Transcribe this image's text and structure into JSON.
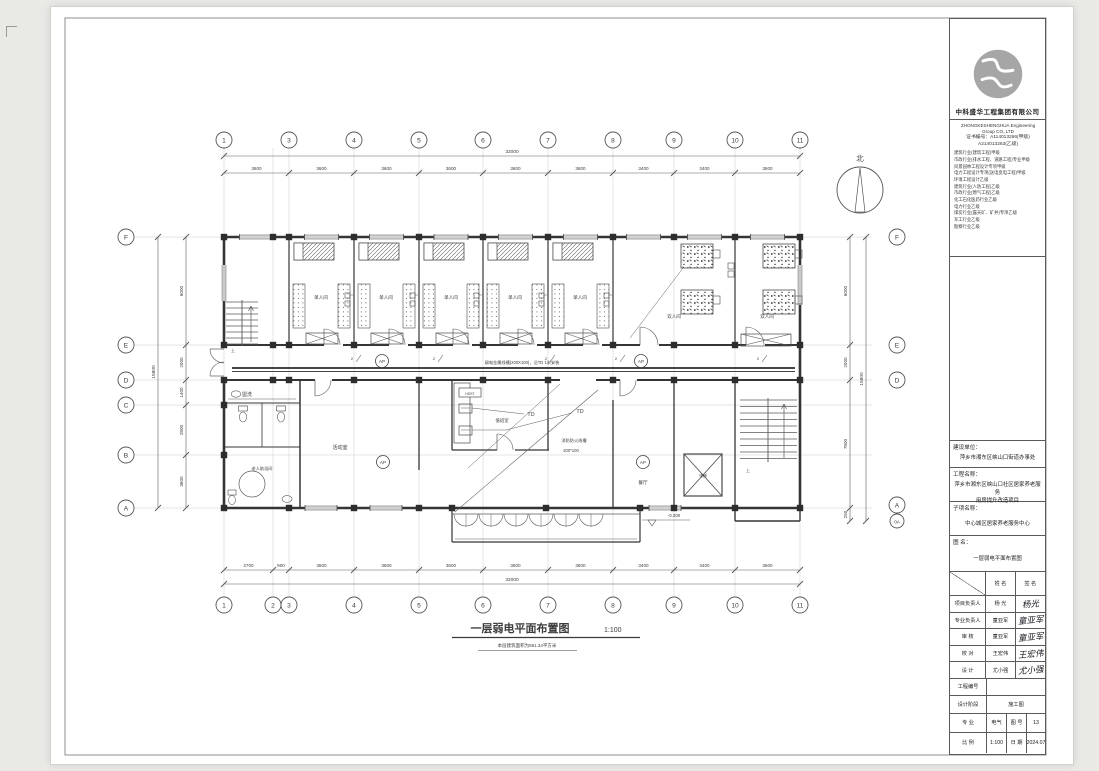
{
  "company": {
    "name_cn": "中科盛华工程集团有限公司",
    "name_en": "ZHONGKESHENGHUA Engineering Group CO.,LTD",
    "cert_line1": "证书编号：A114013266(甲级)",
    "cert_line2": "A214013263(乙级)",
    "qualifications": [
      "建筑行业(建筑工程)甲级",
      "市政行业(排水工程、道路工程)专业甲级",
      "风景园林工程设计专项甲级",
      "电力工程设计专项(送电变电工程)甲级",
      "环境工程设计乙级",
      "建筑行业(人防工程)乙级",
      "市政行业(燃气工程)乙级",
      "化工石化医药行业乙级",
      "电力行业乙级",
      "煤炭行业(露天矿、矿井)专项乙级",
      "军工行业乙级",
      "勘察行业乙级"
    ]
  },
  "title_block": {
    "labels": {
      "client": "建设单位：",
      "project": "工程名称：",
      "subitem": "子项名称：",
      "drawing": "图    名："
    },
    "client": "萍乡市湘东区峡山口街道办事处",
    "project_line1": "萍乡市湘东区峡山口社区居家养老服务",
    "project_line2": "用房提升改造项目",
    "subitem": "中心城区居家养老服务中心",
    "drawing_name": "一层弱电平面布置图",
    "table": {
      "col_name": "姓 名",
      "col_sign": "签 名",
      "rows": [
        {
          "role": "项目负责人",
          "name": "杨 光",
          "sign": "杨光"
        },
        {
          "role": "专业负责人",
          "name": "童亚军",
          "sign": "童亚军"
        },
        {
          "role": "审  核",
          "name": "童亚军",
          "sign": "童亚军"
        },
        {
          "role": "校  对",
          "name": "王宏伟",
          "sign": "王宏伟"
        },
        {
          "role": "设  计",
          "name": "尤小强",
          "sign": "尤小强"
        }
      ],
      "project_no_label": "工程编号",
      "project_no": "",
      "stage_label": "设计阶段",
      "stage": "施工图",
      "discipline_label": "专 业",
      "discipline": "电气",
      "sheet_label": "图 号",
      "sheet_no": "13",
      "scale_label": "比 例",
      "scale": "1:100",
      "date_label": "日 期",
      "date": "2024.07"
    }
  },
  "plan": {
    "title": "一层弱电平面布置图",
    "title_scale": "1:100",
    "subtitle": "本层建筑面积为591.34平方米",
    "north_label": "北",
    "grid_cols": [
      "1",
      "2",
      "3",
      "4",
      "5",
      "6",
      "7",
      "8",
      "9",
      "10",
      "11"
    ],
    "grid_rows_left": [
      "F",
      "E",
      "D",
      "C",
      "B",
      "A"
    ],
    "grid_rows_right": [
      "F",
      "E",
      "D",
      "A",
      "0A"
    ],
    "dims_top": [
      "3600",
      "3600",
      "3600",
      "3600",
      "3600",
      "3600",
      "3400",
      "3400",
      "3600"
    ],
    "dim_top_total": "32000",
    "dims_bottom": [
      "2700",
      "900",
      "3600",
      "3600",
      "3600",
      "3600",
      "3600",
      "3400",
      "3400",
      "3600"
    ],
    "dim_bottom_total": "32000",
    "dims_left": [
      "6000",
      "2000",
      "1400",
      "2800",
      "3600"
    ],
    "dim_left_total": "15800",
    "dims_right": [
      "6000",
      "2000",
      "7800",
      "250"
    ],
    "dim_right_total": "15800",
    "rooms": {
      "single": "单人间",
      "double": "双人间",
      "wash": "盥洗",
      "bath": "老人助浴间",
      "activity": "活动室",
      "duty": "值班室",
      "dining": "餐厅",
      "elevator": "电梯"
    },
    "annotations": {
      "tray": "弱电金属线槽(200X100)，沿TD 1米安装",
      "fire1": "消防防火线槽",
      "fire2": "200*100",
      "td": "TD",
      "ap": "AP",
      "hdst": "HDST",
      "level": "-0.300",
      "circuit": "2",
      "up": "上"
    }
  }
}
